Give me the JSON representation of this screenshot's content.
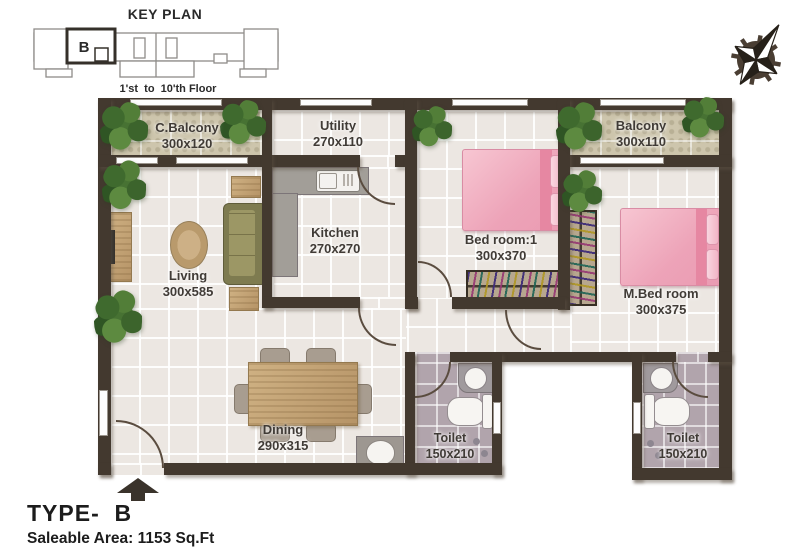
{
  "header": {
    "key_plan_title": "KEY PLAN",
    "key_plan_unit": "B",
    "key_plan_floors": "1'st  to  10'th Floor"
  },
  "rooms": {
    "c_balcony": {
      "name": "C.Balcony",
      "dims": "300x120"
    },
    "utility": {
      "name": "Utility",
      "dims": "270x110"
    },
    "balcony": {
      "name": "Balcony",
      "dims": "300x110"
    },
    "living": {
      "name": "Living",
      "dims": "300x585"
    },
    "kitchen": {
      "name": "Kitchen",
      "dims": "270x270"
    },
    "bedroom1": {
      "name": "Bed room:1",
      "dims": "300x370"
    },
    "master_bedroom": {
      "name": "M.Bed room",
      "dims": "300x375"
    },
    "dining": {
      "name": "Dining",
      "dims": "290x315"
    },
    "toilet1": {
      "name": "Toilet",
      "dims": "150x210"
    },
    "toilet2": {
      "name": "Toilet",
      "dims": "150x210"
    }
  },
  "footer": {
    "type_label": "TYPE-  B",
    "saleable_area": "Saleable Area: 1153 Sq.Ft"
  },
  "colors": {
    "wall": "#43392f",
    "floor": "#ece7e2",
    "balcony_floor": "#cdc5ac",
    "toilet_floor": "#b1a4ac",
    "bed_pink": "#f2b0c1",
    "wood": "#c2a478",
    "plant_green": "#4a7434"
  }
}
